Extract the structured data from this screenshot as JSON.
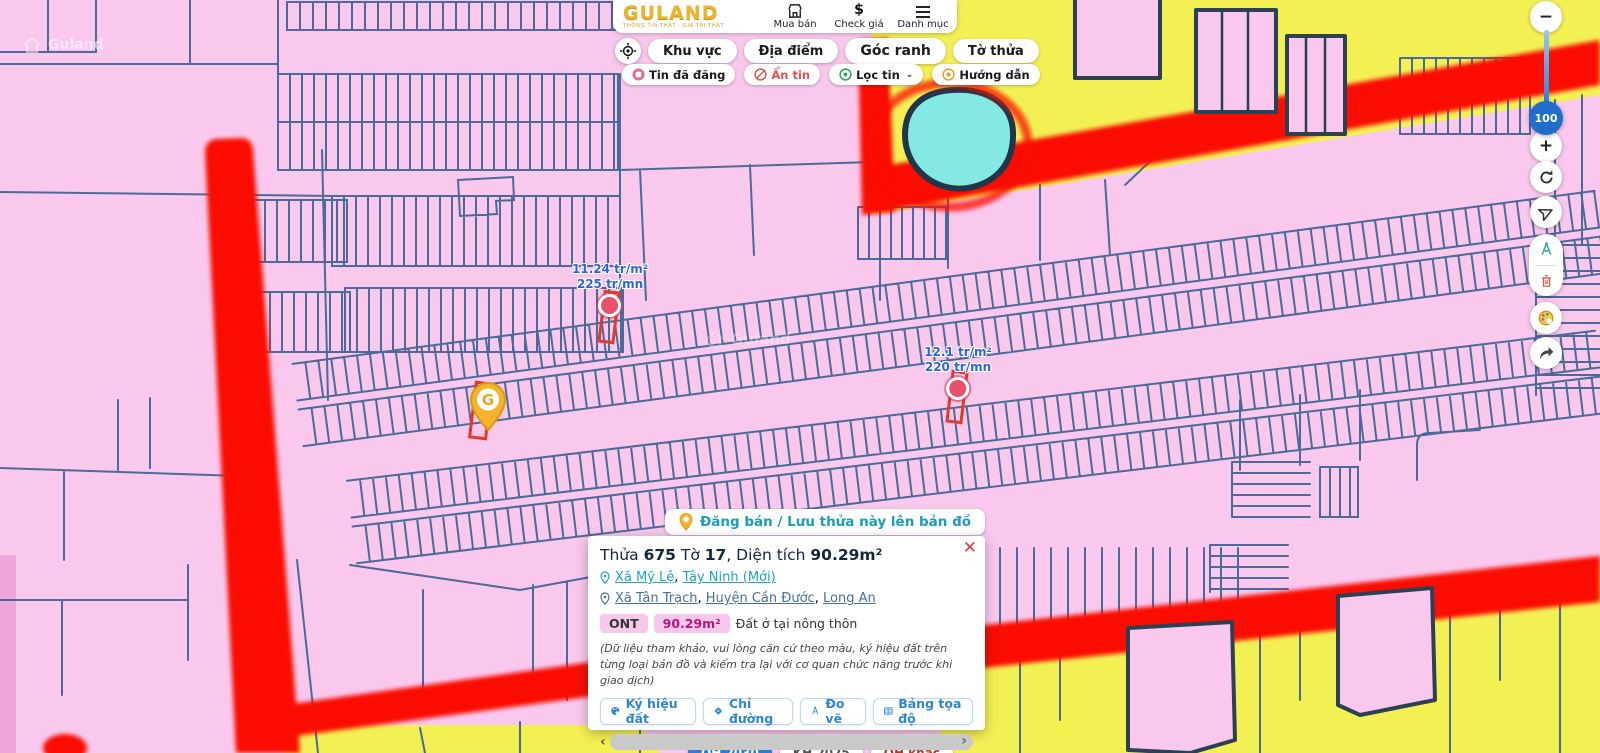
{
  "header": {
    "logo": {
      "title": "GULAND",
      "tagline": "THÔNG TIN THẬT - GIÁ TRỊ THẬT"
    },
    "menu": [
      {
        "label": "Mua bán",
        "icon": "storefront-icon"
      },
      {
        "label": "Check giá",
        "icon": "dollar-icon",
        "glyph": "$"
      },
      {
        "label": "Danh mục",
        "icon": "menu-icon"
      }
    ]
  },
  "toolbar": {
    "tabs": [
      {
        "label": "Khu vực"
      },
      {
        "label": "Địa điểm"
      },
      {
        "label": "Góc ranh"
      },
      {
        "label": "Tờ thửa"
      }
    ],
    "filters": [
      {
        "label": "Tin đã đăng"
      },
      {
        "label": "Ẩn tin"
      },
      {
        "label": "Lọc tin",
        "chevron": "⌄"
      },
      {
        "label": "Hướng dẫn"
      }
    ]
  },
  "controls": {
    "zoom_out": "−",
    "zoom_in": "+",
    "zoom_value": "100"
  },
  "map": {
    "watermark": "Guland",
    "price_markers": [
      {
        "price": "11.24 tr/m²",
        "rent": "225 tr/mn"
      },
      {
        "price": "12.1 tr/m²",
        "rent": "220 tr/mn"
      }
    ],
    "pin_letter": "G"
  },
  "save_bar": {
    "label": "Đăng bán / Lưu thửa này lên bản đồ"
  },
  "popup": {
    "close": "✕",
    "title": {
      "p1": "Thửa",
      "b1": "675",
      "p2": "Tờ",
      "b2": "17",
      "p3": ", Diện tích",
      "b3": "90.29m²"
    },
    "loc1": {
      "a": "Xã Mỹ Lệ",
      "sep": ",",
      "b": "Tây Ninh (Mới)"
    },
    "loc2": {
      "a": "Xã Tân Trạch",
      "s1": ",",
      "b": "Huyện Cần Đước",
      "s2": ",",
      "c": "Long An"
    },
    "badge_code": "ONT",
    "badge_area": "90.29m²",
    "land_type": "Đất ở tại nông thôn",
    "disclaimer": "(Dữ liệu tham khảo, vui lòng căn cứ theo màu, ký hiệu đất trên từng loại bản đồ và kiểm tra lại với cơ quan chức năng trước khi giao dịch)",
    "actions": [
      {
        "label": "Ký hiệu đất",
        "icon": "palette-icon"
      },
      {
        "label": "Chỉ đường",
        "icon": "directions-icon"
      },
      {
        "label": "Đo vẽ",
        "icon": "compass-icon"
      },
      {
        "label": "Bảng tọa độ",
        "icon": "table-icon"
      }
    ],
    "scroll": {
      "left": "‹",
      "right": "›"
    }
  },
  "bottom_tabs": [
    {
      "label": "QH 2030"
    },
    {
      "label": "KH 2025"
    },
    {
      "label": "QH khác"
    }
  ],
  "colors": {
    "map_pink": "#f9c8ec",
    "parcel_line": "#4a6b99",
    "road_red": "#fa0f00",
    "parcel_yellow": "#f3f053",
    "water_cyan": "#85e9e3",
    "link_teal": "#1ba6c0",
    "link_steel": "#4a7096",
    "brand_gold": "#eab52c",
    "badge_pink": "#f8c7ec",
    "action_blue": "#2e86d3"
  }
}
